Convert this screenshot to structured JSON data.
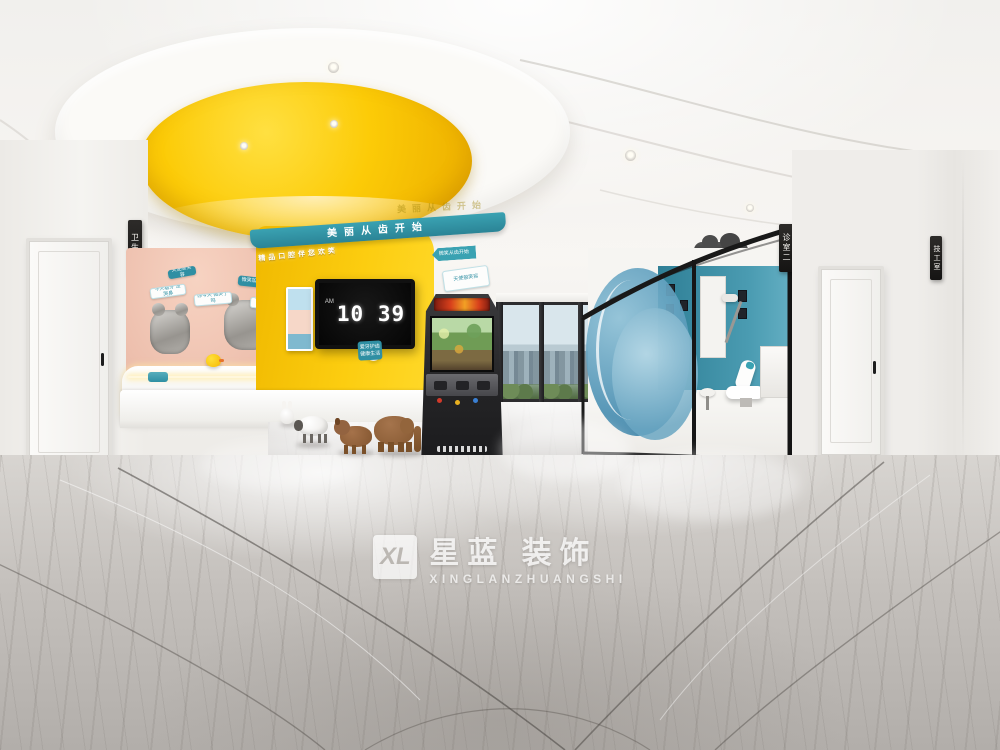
{
  "brand": {
    "monogram": "XL",
    "name_cn": "星蓝 装饰",
    "name_en": "XINGLANZHUANGSHI"
  },
  "clock": {
    "meridiem": "AM",
    "time": "10 39"
  },
  "signs": {
    "restroom": "卫生间",
    "clinic_room": "诊室二",
    "lab_room": "技工室"
  },
  "slogans": {
    "teal_band": "美丽从齿开始",
    "cove_3d": "精品口腔伴您欢笑",
    "tv_badge": "爱牙护齿 健康生活",
    "arrow_decal": "微笑从齿开始"
  },
  "wall_decals": [
    "今天看牙 没哭鼻",
    "你今天 微笑了吗",
    "微笑加油站",
    "今天刷牙了吗",
    "天使般笑容"
  ],
  "colors": {
    "accent_yellow": "#fccd10",
    "accent_teal": "#2f8fa3",
    "wall_pink": "#edbfad",
    "glass_blue": "#4a8fb2",
    "floor_gray": "#c8c4c0"
  }
}
